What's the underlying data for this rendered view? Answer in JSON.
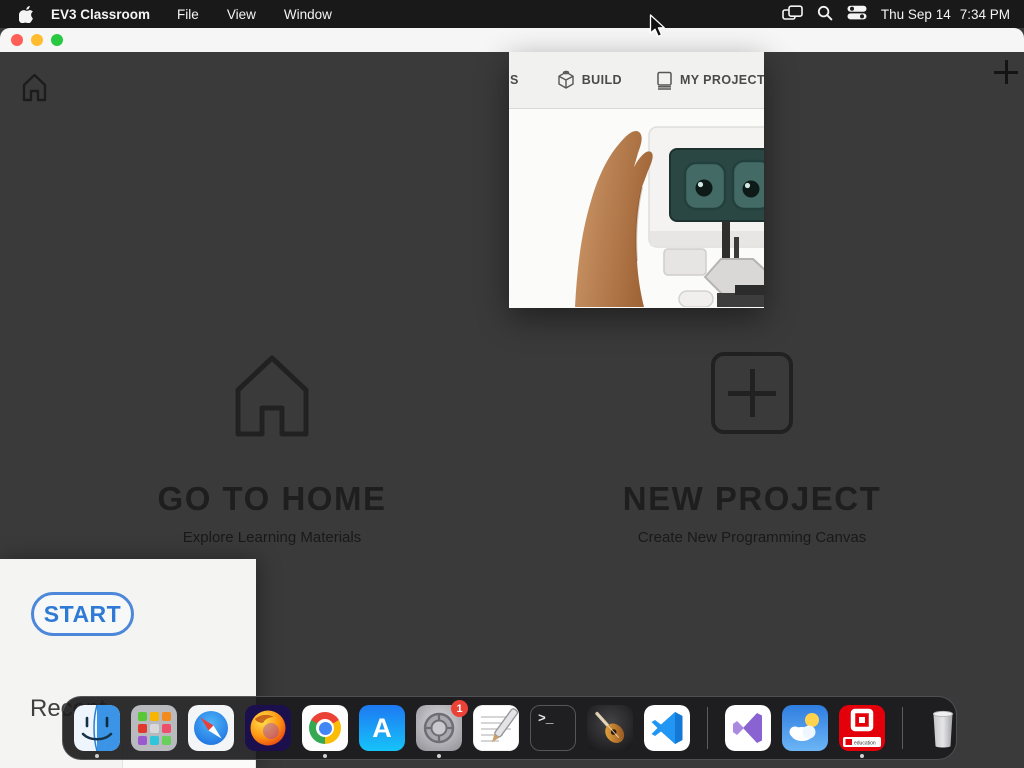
{
  "menu_bar": {
    "app_name": "EV3 Classroom",
    "menus": [
      "File",
      "View",
      "Window"
    ],
    "clock_date": "Thu Sep 14",
    "clock_time": "7:34 PM",
    "status_icons": [
      "window-mirroring-icon",
      "spotlight-search-icon",
      "control-center-icon"
    ]
  },
  "popup": {
    "partial_tab_label": "S",
    "tabs": [
      {
        "label": "BUILD",
        "icon": "lego-brick-icon"
      },
      {
        "label": "MY PROJECTS",
        "icon": "notebook-icon"
      }
    ]
  },
  "launcher": {
    "go_to_home": {
      "title": "GO TO HOME",
      "subtitle": "Explore Learning Materials",
      "icon": "home-outline-icon"
    },
    "new_project": {
      "title": "NEW PROJECT",
      "subtitle": "Create New Programming Canvas",
      "icon": "plus-square-icon"
    }
  },
  "app_header": {
    "icons": [
      "home-icon",
      "plus-icon"
    ]
  },
  "lobby": {
    "start_label": "START",
    "recent_label": "Recent"
  },
  "dock": {
    "apps": [
      "Finder",
      "Launchpad",
      "Safari",
      "Firefox",
      "Google Chrome",
      "App Store",
      "System Settings",
      "TextEdit",
      "Terminal",
      "GarageBand",
      "Visual Studio Code",
      "Visual Studio",
      "Weather",
      "EV3 Classroom",
      "Trash"
    ],
    "running_apps": [
      "Finder",
      "Google Chrome",
      "System Settings",
      "EV3 Classroom"
    ],
    "settings_badge": "1",
    "ev3_banner_label": "education"
  },
  "colors": {
    "accent_blue": "#2e7ad5",
    "dim_background": "#3a3a3a",
    "menu_bar": "#191919",
    "ev3_red": "#e3000b"
  }
}
